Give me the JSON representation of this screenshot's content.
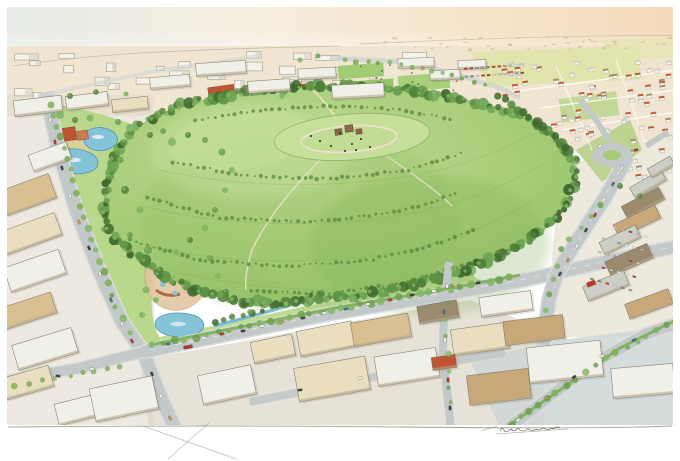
{
  "artwork": {
    "kind": "watercolor-aerial-rendering",
    "subject": "hilltop-park-surrounded-by-city"
  },
  "palette": {
    "paper": "#ffffff",
    "skyL": "#e7ebe7",
    "skyC": "#f6efe1",
    "skyR": "#f6e3c6",
    "skyCorner": "#f3dab9",
    "horizon": "#c9bb9f",
    "groundTan": "#eadfc8",
    "groundWarm": "#f0e5d1",
    "cityWhite": "#f4f2ea",
    "cityGrey": "#d8d5c9",
    "cityLine": "#8f8876",
    "redRoof": "#bd5533",
    "terracotta": "#c4714e",
    "sand": "#e4cf9f",
    "soil": "#d9c79c",
    "fieldYellow": "#dde3a2",
    "fieldGreen": "#a6cc77",
    "lawn": "#b9d88c",
    "grassLight": "#c8e09c",
    "grassMid": "#a6cd79",
    "grassDark": "#84b35a",
    "treeDark": "#3f6a2e",
    "treeMid": "#55853e",
    "treeLight": "#6da151",
    "treeBright": "#82b765",
    "median": "#7fae57",
    "pathTan": "#e9e2c4",
    "pond": "#85c3d8",
    "pondEdge": "#4f94b0",
    "road": "#c3c8c9",
    "roadLight": "#dcdedd",
    "pavement": "#ccd6d6",
    "roofWhite": "#f0efe8",
    "roofCream": "#eadec0",
    "roofTan": "#d9c091",
    "roofTanDark": "#c8a878",
    "roofGrey": "#cdcfc6",
    "roofBrown": "#9c8a6e",
    "bldLine": "#6f6a5a",
    "bldFace": "#b4a98e",
    "carRed": "#b23b2b",
    "carWhite": "#f6f6f1",
    "carDark": "#3c4347",
    "carBlue": "#50708e",
    "carTan": "#c9a45a",
    "pencil": "#8d8779",
    "sig": "#6f6a60"
  },
  "scene": {
    "tree_ring": {
      "points": [
        [
          102,
          212
        ],
        [
          112,
          158
        ],
        [
          138,
          126
        ],
        [
          178,
          106
        ],
        [
          228,
          95
        ],
        [
          285,
          88
        ],
        [
          345,
          85
        ],
        [
          405,
          90
        ],
        [
          462,
          99
        ],
        [
          512,
          112
        ],
        [
          548,
          130
        ],
        [
          570,
          152
        ],
        [
          576,
          178
        ],
        [
          566,
          205
        ],
        [
          543,
          231
        ],
        [
          508,
          252
        ],
        [
          464,
          270
        ],
        [
          412,
          285
        ],
        [
          355,
          296
        ],
        [
          298,
          303
        ],
        [
          246,
          302
        ],
        [
          198,
          292
        ],
        [
          158,
          273
        ],
        [
          126,
          248
        ],
        [
          106,
          228
        ],
        [
          102,
          212
        ]
      ],
      "step": 4.5,
      "colors": [
        "#3f6a2e",
        "#4f8038",
        "#5e9346",
        "#6da453"
      ]
    },
    "hill_shrub_rows": [
      [
        [
          130,
          240
        ],
        [
          200,
          260
        ],
        [
          280,
          266
        ],
        [
          360,
          262
        ],
        [
          430,
          246
        ],
        [
          480,
          228
        ]
      ],
      [
        [
          148,
          198
        ],
        [
          220,
          218
        ],
        [
          310,
          222
        ],
        [
          400,
          212
        ],
        [
          462,
          192
        ]
      ],
      [
        [
          172,
          162
        ],
        [
          248,
          176
        ],
        [
          330,
          179
        ],
        [
          408,
          170
        ],
        [
          466,
          152
        ]
      ],
      [
        [
          252,
          290
        ],
        [
          330,
          294
        ],
        [
          408,
          282
        ],
        [
          468,
          264
        ]
      ],
      [
        [
          196,
          120
        ],
        [
          260,
          110
        ],
        [
          330,
          106
        ],
        [
          400,
          110
        ],
        [
          456,
          120
        ]
      ]
    ],
    "street_tree_lines": [
      {
        "pts": [
          [
            50,
            104
          ],
          [
            70,
            170
          ],
          [
            92,
            240
          ],
          [
            116,
            306
          ],
          [
            138,
            344
          ]
        ],
        "step": 11,
        "r": 3,
        "dark": false
      },
      {
        "pts": [
          [
            152,
            346
          ],
          [
            240,
            328
          ],
          [
            340,
            308
          ],
          [
            440,
            291
          ],
          [
            520,
            276
          ]
        ],
        "step": 10,
        "r": 3.2,
        "dark": false
      },
      {
        "pts": [
          [
            502,
            430
          ],
          [
            556,
            392
          ],
          [
            616,
            352
          ],
          [
            678,
            320
          ]
        ],
        "step": 11,
        "r": 3,
        "dark": false
      },
      {
        "pts": [
          [
            0,
            388
          ],
          [
            70,
            376
          ],
          [
            132,
            364
          ]
        ],
        "step": 12,
        "r": 2.6,
        "dark": false
      },
      {
        "pts": [
          [
            498,
            96
          ],
          [
            530,
            118
          ],
          [
            560,
            142
          ],
          [
            582,
            166
          ]
        ],
        "step": 7,
        "r": 3.6,
        "dark": true
      },
      {
        "pts": [
          [
            452,
            270
          ],
          [
            446,
            320
          ],
          [
            448,
            370
          ],
          [
            452,
            420
          ]
        ],
        "step": 14,
        "r": 2.4,
        "dark": false
      },
      {
        "pts": [
          [
            600,
            205
          ],
          [
            560,
            250
          ],
          [
            548,
            295
          ],
          [
            546,
            325
          ]
        ],
        "step": 13,
        "r": 2.4,
        "dark": false
      },
      {
        "pts": [
          [
            214,
            322
          ],
          [
            262,
            310
          ],
          [
            310,
            296
          ],
          [
            330,
            290
          ]
        ],
        "step": 9,
        "r": 2.8,
        "dark": true
      },
      {
        "pts": [
          [
            344,
            60
          ],
          [
            402,
            64
          ],
          [
            452,
            74
          ],
          [
            498,
            88
          ]
        ],
        "step": 10,
        "r": 2.4,
        "dark": false
      }
    ],
    "scatter_trees": [
      [
        60,
        115,
        4
      ],
      [
        75,
        120,
        3
      ],
      [
        90,
        118,
        3.5
      ],
      [
        118,
        122,
        3
      ],
      [
        130,
        128,
        4
      ],
      [
        150,
        135,
        3
      ],
      [
        163,
        131,
        3
      ],
      [
        172,
        142,
        4
      ],
      [
        120,
        160,
        3.5
      ],
      [
        108,
        172,
        3
      ],
      [
        125,
        190,
        4
      ],
      [
        140,
        210,
        3.5
      ],
      [
        130,
        235,
        3
      ],
      [
        148,
        250,
        4
      ],
      [
        160,
        270,
        3.5
      ],
      [
        176,
        252,
        3
      ],
      [
        190,
        240,
        3
      ],
      [
        205,
        228,
        3.5
      ],
      [
        215,
        210,
        3
      ],
      [
        225,
        190,
        3
      ],
      [
        232,
        170,
        3
      ],
      [
        222,
        152,
        3.5
      ],
      [
        205,
        140,
        3
      ],
      [
        188,
        135,
        3
      ],
      [
        146,
        290,
        3.5
      ],
      [
        142,
        315,
        3
      ],
      [
        210,
        258,
        3
      ],
      [
        218,
        276,
        3.2
      ],
      [
        226,
        292,
        3
      ],
      [
        156,
        300,
        3
      ],
      [
        250,
        312,
        2.8
      ],
      [
        286,
        304,
        2.6
      ],
      [
        356,
        300,
        2.6
      ],
      [
        300,
        60,
        2.5
      ],
      [
        318,
        56,
        2.5
      ],
      [
        282,
        96,
        2.8
      ],
      [
        620,
        186,
        3
      ],
      [
        640,
        196,
        2.6
      ],
      [
        70,
        96,
        3
      ],
      [
        96,
        92,
        2.8
      ],
      [
        126,
        94,
        2.6
      ]
    ],
    "cars": [
      [
        50,
        120,
        80
      ],
      [
        55,
        142,
        78
      ],
      [
        62,
        168,
        76
      ],
      [
        70,
        196,
        72
      ],
      [
        79,
        222,
        70
      ],
      [
        89,
        248,
        68
      ],
      [
        100,
        274,
        66
      ],
      [
        111,
        300,
        63
      ],
      [
        122,
        324,
        60
      ],
      [
        132,
        341,
        57
      ],
      [
        152,
        374,
        67
      ],
      [
        161,
        396,
        66
      ],
      [
        170,
        418,
        65
      ],
      [
        58,
        376,
        10
      ],
      [
        92,
        369,
        10
      ],
      [
        168,
        344,
        -11
      ],
      [
        204,
        338,
        -11
      ],
      [
        222,
        334,
        -11
      ],
      [
        243,
        331,
        -11
      ],
      [
        262,
        326,
        -10
      ],
      [
        282,
        322,
        -10
      ],
      [
        303,
        318,
        -10
      ],
      [
        324,
        313,
        -10
      ],
      [
        346,
        309,
        -10
      ],
      [
        368,
        304,
        -9
      ],
      [
        390,
        300,
        -9
      ],
      [
        412,
        295,
        -9
      ],
      [
        434,
        291,
        -9
      ],
      [
        456,
        287,
        -9
      ],
      [
        478,
        283,
        -9
      ],
      [
        622,
        168,
        122
      ],
      [
        613,
        184,
        121
      ],
      [
        604,
        200,
        120
      ],
      [
        595,
        215,
        119
      ],
      [
        586,
        230,
        118
      ],
      [
        577,
        246,
        117
      ],
      [
        568,
        260,
        116
      ],
      [
        560,
        274,
        115
      ],
      [
        447,
        286,
        92
      ],
      [
        444,
        312,
        92
      ],
      [
        445,
        340,
        91
      ],
      [
        448,
        380,
        89
      ],
      [
        450,
        408,
        88
      ],
      [
        518,
        420,
        -38
      ],
      [
        546,
        398,
        -36
      ],
      [
        574,
        377,
        -33
      ],
      [
        602,
        356,
        -30
      ],
      [
        634,
        340,
        -26
      ],
      [
        600,
        146,
        -40
      ],
      [
        636,
        150,
        -15
      ],
      [
        300,
        390,
        -11
      ],
      [
        360,
        378,
        -11
      ]
    ],
    "car_colors": [
      "carWhite",
      "carRed",
      "carDark",
      "carWhite",
      "carTan",
      "carDark",
      "carWhite",
      "carBlue"
    ],
    "bus": {
      "x": 188,
      "y": 347,
      "rot": -11,
      "color": "carRed"
    },
    "buildings": [
      [
        30,
        148,
        40,
        18,
        -20,
        "roofWhite"
      ],
      [
        0,
        182,
        54,
        26,
        -20,
        "roofTan"
      ],
      [
        0,
        222,
        60,
        24,
        -20,
        "roofCream"
      ],
      [
        6,
        258,
        58,
        26,
        -19,
        "roofWhite"
      ],
      [
        0,
        300,
        55,
        22,
        -18,
        "roofTan"
      ],
      [
        14,
        336,
        62,
        26,
        -17,
        "roofWhite"
      ],
      [
        0,
        372,
        52,
        22,
        -16,
        "roofCream"
      ],
      [
        56,
        398,
        50,
        22,
        -14,
        "roofWhite"
      ],
      [
        92,
        382,
        64,
        34,
        -12,
        "roofWhite"
      ],
      [
        14,
        98,
        48,
        16,
        -7,
        "roofWhite"
      ],
      [
        66,
        94,
        42,
        14,
        -7,
        "roofWhite"
      ],
      [
        112,
        98,
        36,
        13,
        -6,
        "roofCream"
      ],
      [
        150,
        76,
        40,
        12,
        -5,
        "roofWhite"
      ],
      [
        196,
        62,
        50,
        13,
        -4,
        "roofWhite"
      ],
      [
        248,
        80,
        42,
        12,
        -4,
        "roofWhite"
      ],
      [
        298,
        68,
        38,
        11,
        -3,
        "roofWhite"
      ],
      [
        332,
        84,
        52,
        14,
        -3,
        "roofWhite"
      ],
      [
        398,
        58,
        36,
        10,
        -2,
        "roofWhite"
      ],
      [
        430,
        70,
        30,
        10,
        -3,
        "roofWhite"
      ],
      [
        458,
        60,
        28,
        9,
        -2,
        "roofWhite"
      ],
      [
        200,
        370,
        54,
        30,
        -12,
        "roofWhite"
      ],
      [
        252,
        338,
        42,
        22,
        -12,
        "roofCream"
      ],
      [
        298,
        326,
        56,
        26,
        -11,
        "roofCream"
      ],
      [
        352,
        318,
        58,
        24,
        -10,
        "roofTan"
      ],
      [
        296,
        362,
        72,
        34,
        -10,
        "roofCream"
      ],
      [
        376,
        352,
        62,
        30,
        -9,
        "roofWhite"
      ],
      [
        418,
        303,
        40,
        18,
        -10,
        "roofBrown"
      ],
      [
        452,
        326,
        56,
        26,
        -8,
        "roofCream"
      ],
      [
        432,
        356,
        24,
        13,
        -8,
        "redRoof"
      ],
      [
        468,
        372,
        62,
        30,
        -7,
        "roofTanDark"
      ],
      [
        504,
        318,
        60,
        24,
        -7,
        "roofTanDark"
      ],
      [
        480,
        294,
        52,
        20,
        -8,
        "roofWhite"
      ],
      [
        528,
        344,
        74,
        36,
        -6,
        "roofWhite"
      ],
      [
        612,
        366,
        62,
        30,
        -5,
        "roofWhite"
      ],
      [
        630,
        178,
        36,
        12,
        -30,
        "roofGrey"
      ],
      [
        622,
        196,
        42,
        14,
        -28,
        "roofBrown"
      ],
      [
        614,
        214,
        46,
        15,
        -26,
        "roofTanDark"
      ],
      [
        600,
        233,
        40,
        14,
        -26,
        "roofGrey"
      ],
      [
        606,
        252,
        46,
        16,
        -24,
        "roofBrown"
      ],
      [
        584,
        278,
        44,
        16,
        -22,
        "roofGrey"
      ],
      [
        626,
        296,
        46,
        16,
        -20,
        "roofTanDark"
      ],
      [
        648,
        162,
        26,
        10,
        -30,
        "roofGrey"
      ]
    ],
    "signs": [
      [
        586,
        283,
        9,
        5,
        -22
      ]
    ],
    "red_roofs": [
      [
        208,
        86,
        26,
        7,
        -8
      ],
      [
        236,
        93,
        20,
        6,
        -8
      ],
      [
        260,
        98,
        18,
        6,
        -8
      ],
      [
        298,
        84,
        14,
        5,
        -4
      ],
      [
        342,
        99,
        22,
        6,
        -4
      ],
      [
        370,
        106,
        16,
        5,
        -4
      ]
    ],
    "city_boxes": {
      "x": 12,
      "y": 50,
      "w": 430,
      "h": 50,
      "count": 30
    },
    "horizon_marks": {
      "x": 380,
      "y": 36,
      "w": 290,
      "h": 14,
      "count": 40
    },
    "houses": {
      "zones": [
        {
          "x": 500,
          "y": 60,
          "w": 176,
          "h": 48,
          "count": 46,
          "rot": -8
        },
        {
          "x": 545,
          "y": 108,
          "w": 131,
          "h": 38,
          "count": 26,
          "rot": -8
        },
        {
          "x": 612,
          "y": 146,
          "w": 64,
          "h": 36,
          "count": 12,
          "rot": -8
        }
      ],
      "roof_colors": [
        "redRoof",
        "redRoof",
        "roofGrey",
        "roofBrown",
        "redRoof",
        "roofGrey"
      ]
    },
    "parking_grids": [
      {
        "x": 464,
        "y": 68,
        "cols": 11,
        "rows": 2,
        "dx": 5.6,
        "dy": 8,
        "rot": -4
      },
      {
        "x": 606,
        "y": 224,
        "cols": 6,
        "rows": 5,
        "dx": 8,
        "dy": 14,
        "rot": 16
      }
    ],
    "orchard": {
      "x": 143,
      "y": 178,
      "rows": 8,
      "cols": 12,
      "dx": 8,
      "dy": 9,
      "rot": -20
    },
    "field_players": {
      "x": 346,
      "y": 63,
      "w": 115,
      "h": 30,
      "count": 26
    },
    "summit": {
      "structures": [
        [
          335,
          129,
          7,
          6,
          -8
        ],
        [
          345,
          125,
          8,
          7,
          -6
        ],
        [
          356,
          129,
          6,
          5,
          -4
        ]
      ],
      "people": [
        [
          320,
          141
        ],
        [
          331,
          146
        ],
        [
          340,
          133
        ],
        [
          352,
          144
        ],
        [
          361,
          139
        ],
        [
          370,
          147
        ],
        [
          311,
          136
        ],
        [
          356,
          150
        ],
        [
          345,
          151
        ]
      ]
    },
    "pencil_strokes": [
      [
        143,
        426,
        236,
        459
      ],
      [
        209,
        423,
        168,
        459
      ],
      [
        481,
        431,
        497,
        426
      ]
    ],
    "signature": {
      "x": 500,
      "y": 431,
      "underline_x2": 568
    }
  }
}
